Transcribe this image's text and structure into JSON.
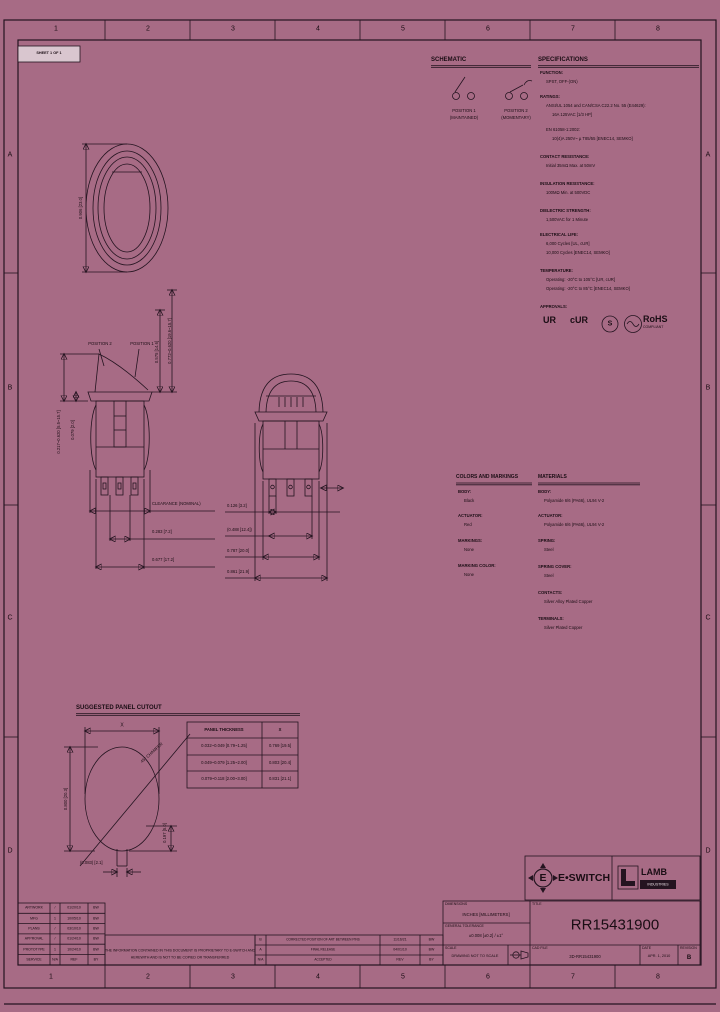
{
  "page": {
    "bg": "#a76b85",
    "ink": "#241420"
  },
  "margins": {
    "cols": [
      "1",
      "2",
      "3",
      "4",
      "5",
      "6",
      "7",
      "8"
    ],
    "rows": [
      "A",
      "B",
      "C",
      "D"
    ],
    "sheet_label": "SHEET 1 OF 1"
  },
  "schematic": {
    "title": "SCHEMATIC",
    "pos1": "POSITION 1",
    "pos1_sub": "(MAINTAINED)",
    "pos2": "POSITION 2",
    "pos2_sub": "(MOMENTARY)"
  },
  "specs": {
    "title": "SPECIFICATIONS",
    "function_h": "FUNCTION:",
    "function_1": "SPST, OFF-(ON)",
    "ratings_h": "RATINGS:",
    "ratings_1": "ANSI/UL 1054 and CAN/CSA C22.2 No. 55 (E44629):",
    "ratings_2": "16A 125VAC [1/3 HP]",
    "ratings_3": "EN 61058-1:2002:",
    "ratings_4": "10(4)A 250V~ µ T85/55 [ENEC14, SEMKO]",
    "contact_h": "CONTACT RESISTANCE:",
    "contact_1": "Initial 35mΩ Max. at 50mV",
    "insulation_h": "INSULATION RESISTANCE:",
    "insulation_1": "100MΩ Min. at 500VDC",
    "dielectric_h": "DIELECTRIC STRENGTH:",
    "dielectric_1": "1,500VAC for 1 Minute",
    "electrical_h": "ELECTRICAL LIFE:",
    "electrical_1": "6,000 Cycles [UL, cUR]",
    "electrical_2": "10,000 Cycles [ENEC14, SEMKO]",
    "temp_h": "TEMPERATURE:",
    "temp_1": "Operating: -20°C to 105°C [UR, cUR]",
    "temp_2": "Operating: -20°C to 85°C [ENEC14, SEMKO]",
    "approvals_h": "APPROVALS:",
    "logo_ur": "UR",
    "logo_cur": "cUR",
    "logo_s": "S",
    "logo_rohs": "RoHS",
    "logo_rohs_sub": "COMPLIANT"
  },
  "colors": {
    "title": "COLORS AND MARKINGS",
    "body_h": "BODY:",
    "body": "Black",
    "actuator_h": "ACTUATOR:",
    "actuator": "Red",
    "markings_h": "MARKINGS:",
    "markings": "None",
    "marking_color_h": "MARKING COLOR:",
    "marking_color": "None"
  },
  "materials": {
    "title": "MATERIALS",
    "body_h": "BODY:",
    "body": "Polyamide 6/6 (PA66), UL94 V-2",
    "actuator_h": "ACTUATOR:",
    "actuator": "Polyamide 6/6 (PA66), UL94 V-2",
    "spring_h": "SPRING:",
    "spring": "Steel",
    "spring_cover_h": "SPRING COVER:",
    "spring_cover": "Steel",
    "contacts_h": "CONTACTS:",
    "contacts": "Silver Alloy Plated Copper",
    "terminals_h": "TERMINALS:",
    "terminals": "Silver Plated Copper"
  },
  "dims": {
    "front_dia": "0.906 [23.0]",
    "pos2": "POSITION 2",
    "pos1": "POSITION 1",
    "sv1_left_outer": "0.217~0.620 [5.5~15.7]",
    "sv1_left_inner": "0.079 [2.0]",
    "sv1_right_inner": "0.575 [14.6]",
    "sv1_right_outer": "0.772~0.620 [19.6~15.7]",
    "sv1_callouts": [
      "CLEARANCE (NOMINAL)",
      "0.283 [7.2]",
      "0.677 [17.2]"
    ],
    "sv2_callouts": [
      "0.126 [3.2]",
      "(0.488 [12.4])",
      "0.787 [20.0]",
      "0.861 [21.9]"
    ]
  },
  "cutout": {
    "title": "SUGGESTED PANEL CUTOUT",
    "x_label": "X",
    "dia_v": "0.800 [20.3]",
    "keyway_pos": "0.197 [5.0]",
    "keyway_w": "(0.083) [2.1]",
    "diag_note": "45° CHAMFER",
    "table": {
      "h1": "PANEL THICKNESS",
      "h2": "X",
      "rows": [
        {
          "t": "0.032~0.049 [0.79~1.25]",
          "x": "0.769 [19.5]"
        },
        {
          "t": "0.049~0.079 [1.25~2.00]",
          "x": "0.803 [20.4]"
        },
        {
          "t": "0.079~0.118 [2.00~3.00]",
          "x": "0.831 [21.1]"
        }
      ]
    }
  },
  "titleblock": {
    "dims_h": "DIMENSIONS",
    "dims_v": "INCHES [MILLIMETERS]",
    "tol_h": "GENERAL TOLERANCE",
    "tol_v": "±0.008 [±0.2] / ±1°",
    "scale_h": "SCALE",
    "scale_v": "DRAWING NOT TO SCALE",
    "title_h": "TITLE",
    "part_number": "RR15431900",
    "cad_h": "CAD FILE",
    "cad_v": "3D-RR15431900",
    "date_h": "DATE",
    "date_v": "APR. 1, 2010",
    "rev_h": "REVISION",
    "rev_v": "B",
    "eswitch_e": "E",
    "eswitch": "E•SWITCH",
    "lamb": "LAMB",
    "lamb_sub": "INDUSTRIES",
    "prop_1": "THE INFORMATION CONTAINED IN THIS DOCUMENT IS PROPRIETARY TO E-SWITCH AND",
    "prop_2": "HEREWITH AND IS NOT TO BE COPIED OR TRANSFERRED",
    "left_table": {
      "rows": [
        [
          "ARTWORK",
          "/",
          "01/20/10",
          "BW"
        ],
        [
          "MFG",
          "1",
          "10/05/10",
          "BW"
        ],
        [
          "PLANS",
          "/",
          "03/10/10",
          "BW"
        ],
        [
          "APPROVAL",
          "/",
          "01/24/10",
          "BW"
        ],
        [
          "PROTOTYPE",
          "1",
          "10/24/10",
          "BW"
        ],
        [
          "SERVICE",
          "N/A",
          "REF",
          "BY"
        ]
      ]
    },
    "rev_table": {
      "rows": [
        [
          "B",
          "CORRECTED POSITION OF ART BETWEEN PINS",
          "11/16/21",
          "BW"
        ],
        [
          "A",
          "FINAL RELEASE",
          "04/01/10",
          "BW"
        ],
        [
          "N/A",
          "ACCEPTED",
          "REV",
          "BY"
        ]
      ]
    }
  }
}
